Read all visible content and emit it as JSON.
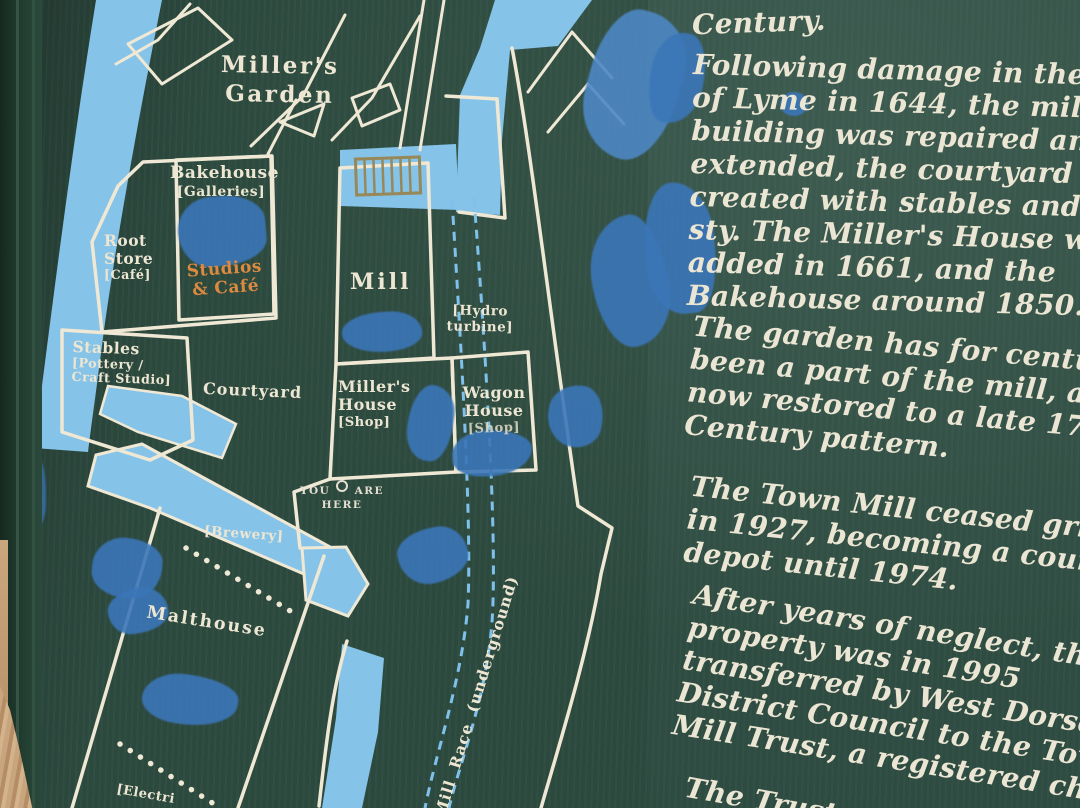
{
  "colors": {
    "board_green": "#2d4a3f",
    "line_cream": "#efe8d4",
    "water_blue": "#86c3e9",
    "smudge_blue": "#3b76b8",
    "accent_orange": "#dd8a41",
    "grate_tan": "#97885a"
  },
  "map": {
    "garden_title": {
      "line1": "Miller's",
      "line2": "Garden"
    },
    "bakehouse": {
      "name": "Bakehouse",
      "sub": "[Galleries]"
    },
    "studios_cafe": {
      "line1": "Studios",
      "line2": "& Café"
    },
    "root_store": {
      "line1": "Root",
      "line2": "Store",
      "line3": "[Café]"
    },
    "stables": {
      "line1": "Stables",
      "line2": "[Pottery /",
      "line3": "Craft Studio]"
    },
    "courtyard": "Courtyard",
    "mill": "Mill",
    "hydro_turbine": {
      "line1": "[Hydro",
      "line2": "turbine]"
    },
    "millers_house": {
      "line1": "Miller's",
      "line2": "House",
      "line3": "[Shop]"
    },
    "wagon_house": {
      "line1": "Wagon",
      "line2": "House",
      "line3": "[Shop]"
    },
    "you_are_here": {
      "word1": "YOU",
      "word2": "ARE",
      "word3": "HERE"
    },
    "brewery": "[Brewery]",
    "malthouse": "Malthouse",
    "electricity": "[Electri",
    "mill_race": "Mill Race (underground)"
  },
  "panel": {
    "paragraphs": [
      {
        "lines": [
          "Century."
        ]
      },
      {
        "lines": [
          "Following damage in the Sie",
          "of Lyme in 1644, the mill",
          "building was repaired and",
          "extended, the courtyard bein",
          "created with stables and pig",
          "sty. The Miller's House was",
          "added in 1661, and the",
          "Bakehouse around 1850."
        ]
      },
      {
        "lines": [
          "The garden has for centuries",
          "been a part of the mill, and is",
          "now restored to a late 17th",
          "Century pattern."
        ]
      },
      {
        "lines": [
          "The Town Mill ceased grindin",
          "in 1927, becoming a council",
          "depot until 1974."
        ]
      },
      {
        "lines": [
          "After years of neglect, the",
          "property was in 1995",
          "transferred by West Dorset",
          "District Council to the Town",
          "Mill Trust, a registered charit"
        ]
      },
      {
        "lines": [
          "The Trust"
        ]
      }
    ]
  }
}
